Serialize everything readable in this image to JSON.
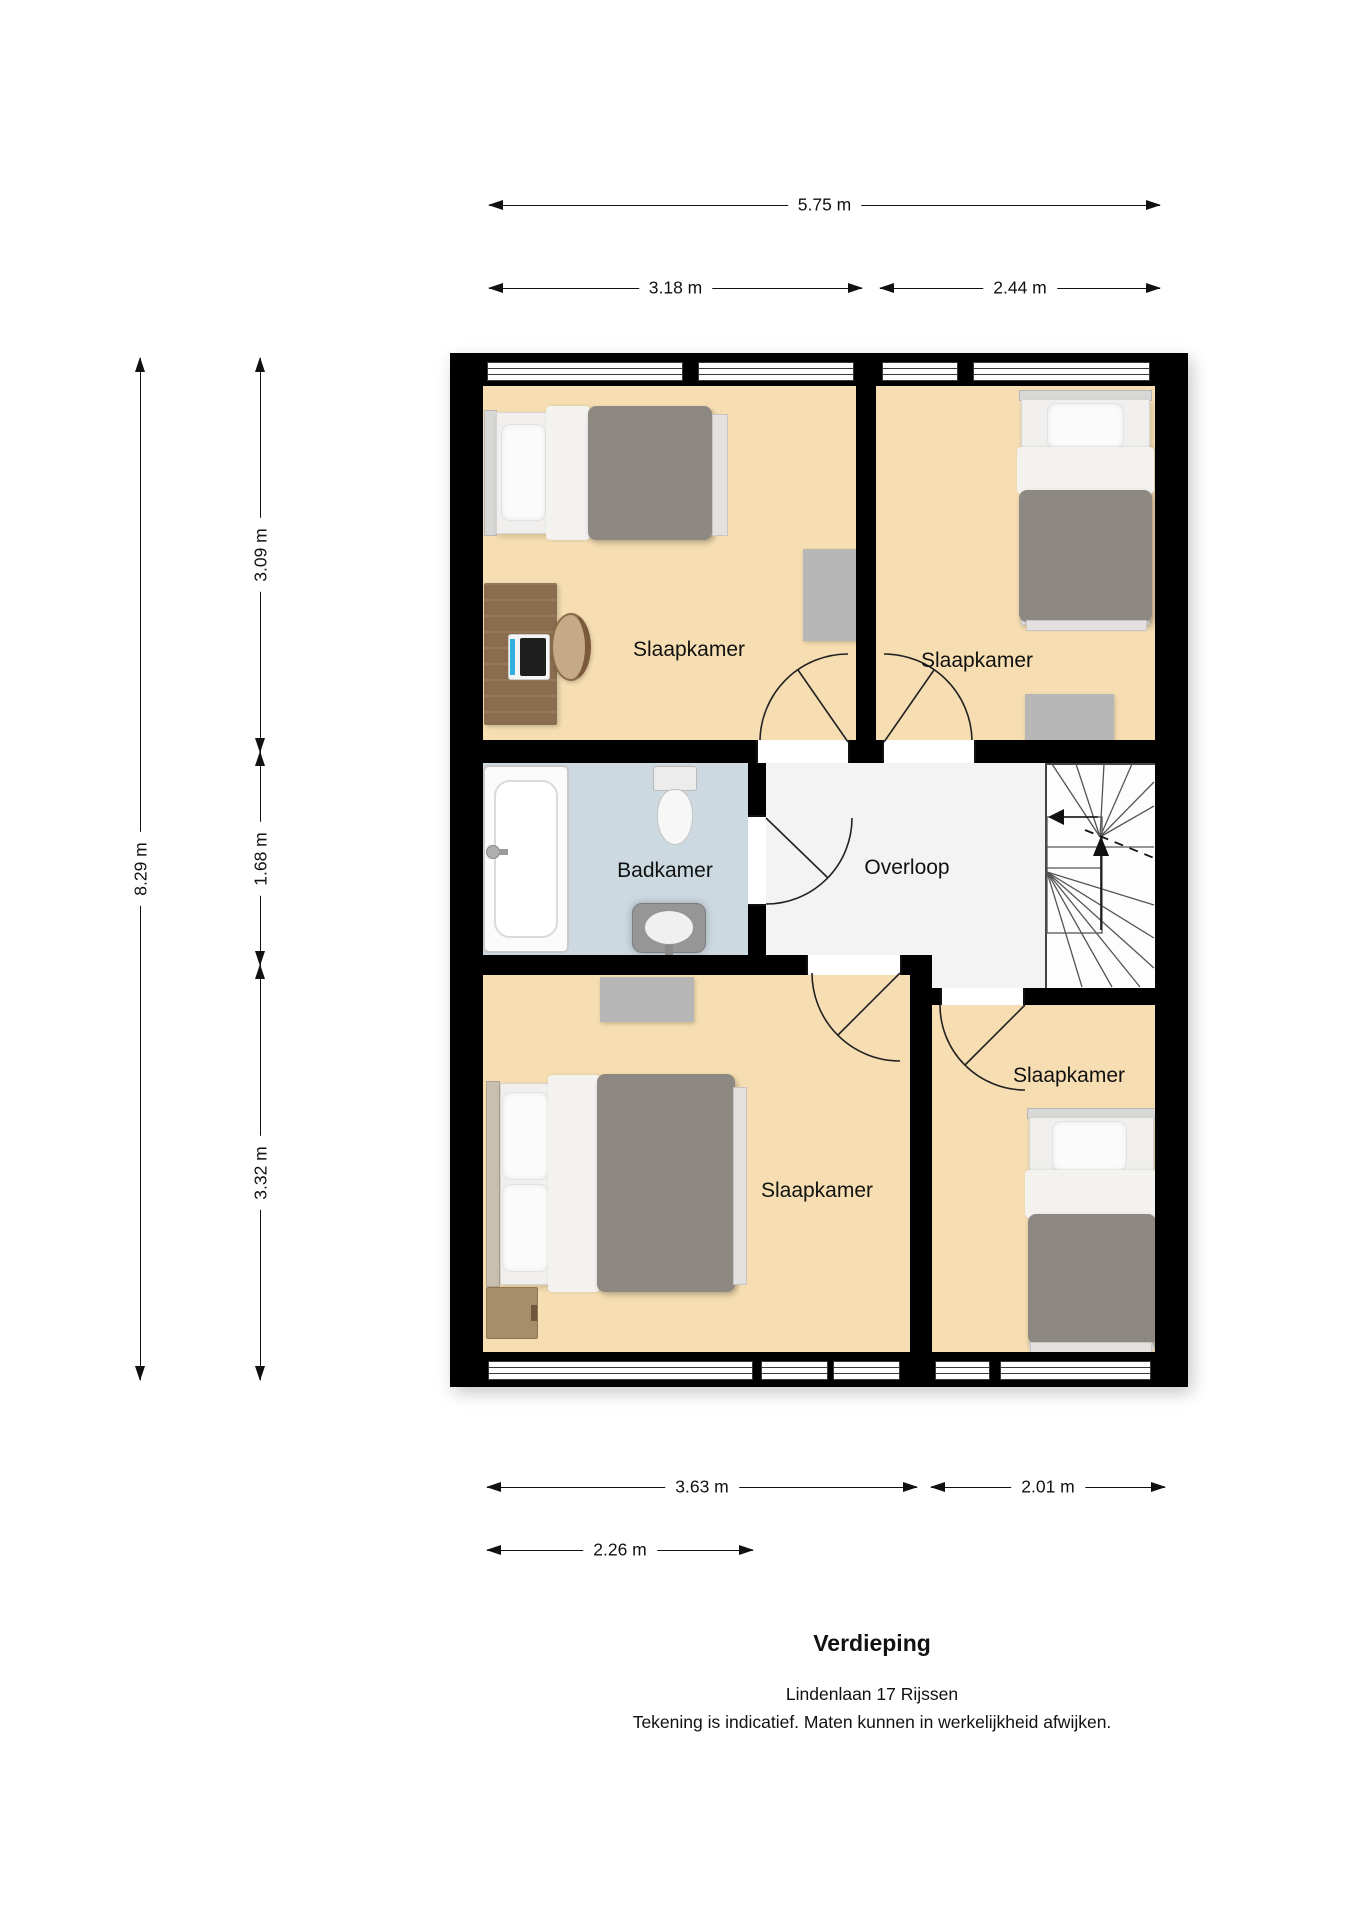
{
  "meta": {
    "title": "Verdieping",
    "address": "Lindenlaan 17 Rijssen",
    "disclaimer": "Tekening is indicatief. Maten kunnen in werkelijkheid afwijken."
  },
  "rooms": {
    "bedroom_top_left": "Slaapkamer",
    "bedroom_top_right": "Slaapkamer",
    "bedroom_bottom_left": "Slaapkamer",
    "bedroom_bottom_right": "Slaapkamer",
    "bathroom": "Badkamer",
    "landing": "Overloop"
  },
  "dimensions": {
    "top_total": "5.75 m",
    "top_left": "3.18 m",
    "top_right": "2.44 m",
    "left_total": "8.29 m",
    "left_top": "3.09 m",
    "left_middle": "1.68 m",
    "left_bottom": "3.32 m",
    "bottom_left": "3.63 m",
    "bottom_right": "2.01 m",
    "bottom_inner": "2.26 m"
  },
  "colors": {
    "wall": "#000000",
    "bedroom_floor": "#f6deb2",
    "bathroom_floor": "#ccd9e0",
    "landing_floor": "#f3f3f3",
    "rug_gray": "#b7b7b7",
    "duvet_gray": "#8e8883",
    "desk_wood": "#8a6c4e",
    "dimension_ink": "#111111"
  }
}
